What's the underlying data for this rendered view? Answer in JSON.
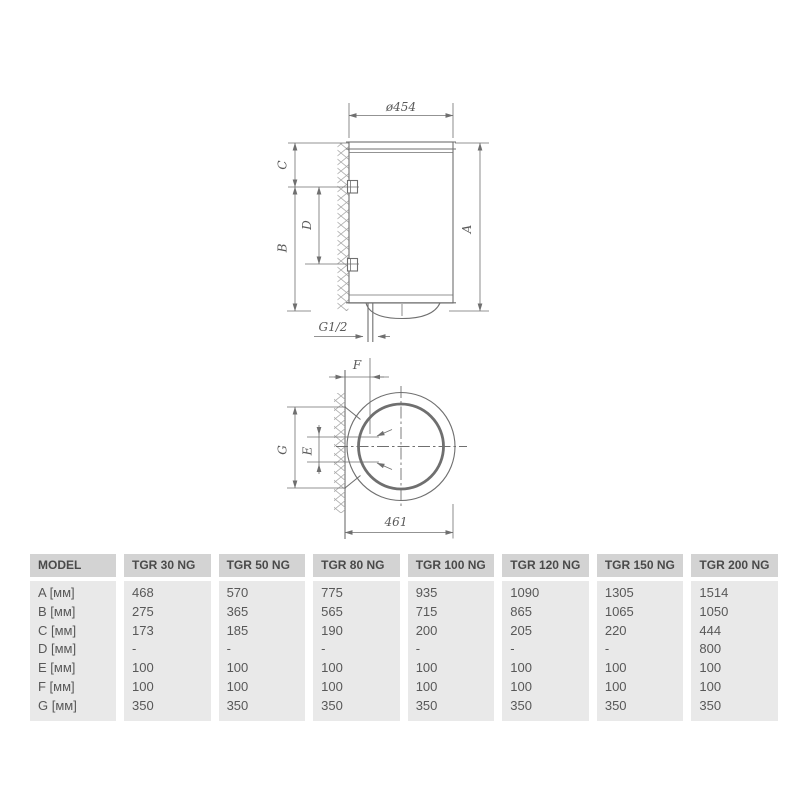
{
  "drawing": {
    "front_view": {
      "diameter_label": "ø454",
      "height_label": "A",
      "upper_offset_label": "C",
      "lower_span_label": "B",
      "bracket_spacing_label": "D",
      "pipe_thread_label": "G1/2"
    },
    "bottom_view": {
      "wall_offset_label": "F",
      "pipe_spacing_label": "E",
      "bracket_span_label": "G",
      "overall_width_label": "461"
    }
  },
  "table": {
    "columns": [
      {
        "header": "MODEL",
        "cells": [
          "A [мм]",
          "B [мм]",
          "C [мм]",
          "D [мм]",
          "E [мм]",
          "F [мм]",
          "G [мм]"
        ]
      },
      {
        "header": "TGR 30 NG",
        "cells": [
          "468",
          "275",
          "173",
          "-",
          "100",
          "100",
          "350"
        ]
      },
      {
        "header": "TGR 50 NG",
        "cells": [
          "570",
          "365",
          "185",
          "-",
          "100",
          "100",
          "350"
        ]
      },
      {
        "header": "TGR 80 NG",
        "cells": [
          "775",
          "565",
          "190",
          "-",
          "100",
          "100",
          "350"
        ]
      },
      {
        "header": "TGR 100 NG",
        "cells": [
          "935",
          "715",
          "200",
          "-",
          "100",
          "100",
          "350"
        ]
      },
      {
        "header": "TGR 120 NG",
        "cells": [
          "1090",
          "865",
          "205",
          "-",
          "100",
          "100",
          "350"
        ]
      },
      {
        "header": "TGR 150 NG",
        "cells": [
          "1305",
          "1065",
          "220",
          "-",
          "100",
          "100",
          "350"
        ]
      },
      {
        "header": "TGR 200 NG",
        "cells": [
          "1514",
          "1050",
          "444",
          "800",
          "100",
          "100",
          "350"
        ]
      }
    ]
  },
  "colors": {
    "header_bg": "#d3d3d3",
    "body_bg": "#e9e9e9",
    "header_text": "#4a4a4a",
    "cell_text": "#585858",
    "line_color": "#6f6f6f",
    "dim_text": "#595959"
  }
}
